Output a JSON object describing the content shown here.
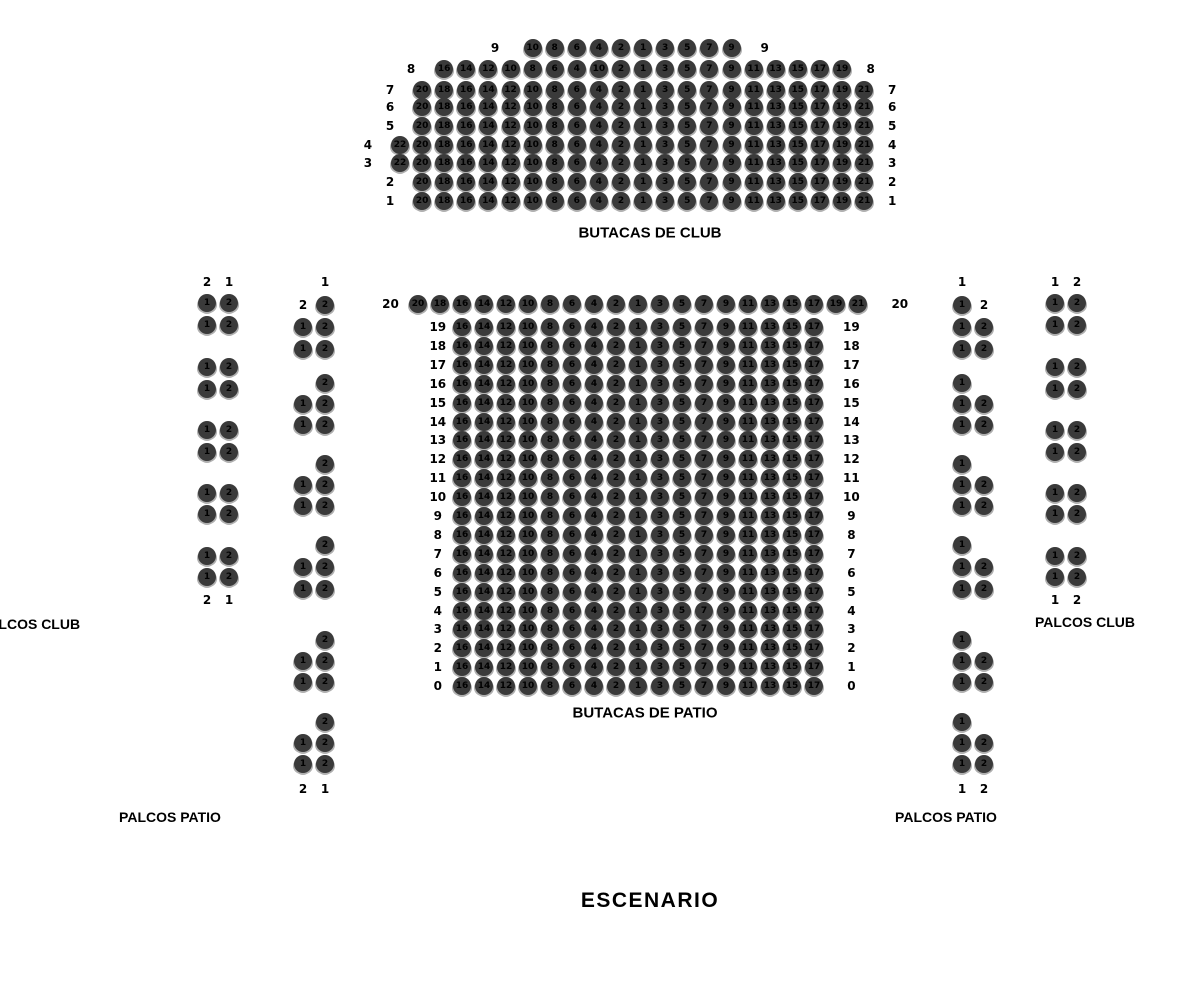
{
  "colors": {
    "background": "#ffffff",
    "seat_fill": "#3a3a3a",
    "seat_shadow": "#b0b0b0",
    "seat_number": "#000000",
    "label_color": "#000000"
  },
  "captions": {
    "club": "BUTACAS DE CLUB",
    "patio": "BUTACAS DE PATIO",
    "stage": "ESCENARIO",
    "palcos_club_left": "PALCOS CLUB",
    "palcos_club_right": "PALCOS CLUB",
    "palcos_patio_left": "PALCOS PATIO",
    "palcos_patio_right": "PALCOS PATIO"
  },
  "club_block": {
    "rows": [
      {
        "label": "9",
        "col": 6,
        "lgap": 1.7,
        "rgap": 1.5,
        "seats": [
          "10",
          "8",
          "6",
          "4",
          "2",
          "1",
          "3",
          "5",
          "7",
          "9"
        ]
      },
      {
        "label": "8",
        "col": 2,
        "lgap": 1.5,
        "rgap": 1.3,
        "seats": [
          "16",
          "14",
          "12",
          "10",
          "8",
          "6",
          "4",
          "10",
          "2",
          "1",
          "3",
          "5",
          "7",
          "9",
          "11",
          "13",
          "15",
          "17",
          "19"
        ]
      },
      {
        "label": "7",
        "col": 1,
        "seats": [
          "20",
          "18",
          "16",
          "14",
          "12",
          "10",
          "8",
          "6",
          "4",
          "2",
          "1",
          "3",
          "5",
          "7",
          "9",
          "11",
          "13",
          "15",
          "17",
          "19",
          "21"
        ]
      },
      {
        "label": "6",
        "col": 1,
        "seats": [
          "20",
          "18",
          "16",
          "14",
          "12",
          "10",
          "8",
          "6",
          "4",
          "2",
          "1",
          "3",
          "5",
          "7",
          "9",
          "11",
          "13",
          "15",
          "17",
          "19",
          "21"
        ]
      },
      {
        "label": "5",
        "col": 1,
        "seats": [
          "20",
          "18",
          "16",
          "14",
          "12",
          "10",
          "8",
          "6",
          "4",
          "2",
          "1",
          "3",
          "5",
          "7",
          "9",
          "11",
          "13",
          "15",
          "17",
          "19",
          "21"
        ]
      },
      {
        "label": "4",
        "col": 0,
        "seats": [
          "22",
          "20",
          "18",
          "16",
          "14",
          "12",
          "10",
          "8",
          "6",
          "4",
          "2",
          "1",
          "3",
          "5",
          "7",
          "9",
          "11",
          "13",
          "15",
          "17",
          "19",
          "21"
        ]
      },
      {
        "label": "3",
        "col": 0,
        "seats": [
          "22",
          "20",
          "18",
          "16",
          "14",
          "12",
          "10",
          "8",
          "6",
          "4",
          "2",
          "1",
          "3",
          "5",
          "7",
          "9",
          "11",
          "13",
          "15",
          "17",
          "19",
          "21"
        ]
      },
      {
        "label": "2",
        "col": 1,
        "seats": [
          "20",
          "18",
          "16",
          "14",
          "12",
          "10",
          "8",
          "6",
          "4",
          "2",
          "1",
          "3",
          "5",
          "7",
          "9",
          "11",
          "13",
          "15",
          "17",
          "19",
          "21"
        ]
      },
      {
        "label": "1",
        "col": 1,
        "seats": [
          "20",
          "18",
          "16",
          "14",
          "12",
          "10",
          "8",
          "6",
          "4",
          "2",
          "1",
          "3",
          "5",
          "7",
          "9",
          "11",
          "13",
          "15",
          "17",
          "19",
          "21"
        ]
      }
    ]
  },
  "patio_block": {
    "rows": [
      {
        "label": "20",
        "col": 0,
        "lgap": 1.25,
        "rgap": 1.9,
        "seats": [
          "20",
          "18",
          "16",
          "14",
          "12",
          "10",
          "8",
          "6",
          "4",
          "2",
          "1",
          "3",
          "5",
          "7",
          "9",
          "11",
          "13",
          "15",
          "17",
          "19",
          "21"
        ]
      },
      {
        "label": "19",
        "col": 2,
        "seats": [
          "16",
          "14",
          "12",
          "10",
          "8",
          "6",
          "4",
          "2",
          "1",
          "3",
          "5",
          "7",
          "9",
          "11",
          "13",
          "15",
          "17"
        ]
      },
      {
        "label": "18",
        "col": 2,
        "seats": [
          "16",
          "14",
          "12",
          "10",
          "8",
          "6",
          "4",
          "2",
          "1",
          "3",
          "5",
          "7",
          "9",
          "11",
          "13",
          "15",
          "17"
        ]
      },
      {
        "label": "17",
        "col": 2,
        "seats": [
          "16",
          "14",
          "12",
          "10",
          "8",
          "6",
          "4",
          "2",
          "1",
          "3",
          "5",
          "7",
          "9",
          "11",
          "13",
          "15",
          "17"
        ]
      },
      {
        "label": "16",
        "col": 2,
        "seats": [
          "16",
          "14",
          "12",
          "10",
          "8",
          "6",
          "4",
          "2",
          "1",
          "3",
          "5",
          "7",
          "9",
          "11",
          "13",
          "15",
          "17"
        ]
      },
      {
        "label": "15",
        "col": 2,
        "seats": [
          "16",
          "14",
          "12",
          "10",
          "8",
          "6",
          "4",
          "2",
          "1",
          "3",
          "5",
          "7",
          "9",
          "11",
          "13",
          "15",
          "17"
        ]
      },
      {
        "label": "14",
        "col": 2,
        "seats": [
          "16",
          "14",
          "12",
          "10",
          "8",
          "6",
          "4",
          "2",
          "1",
          "3",
          "5",
          "7",
          "9",
          "11",
          "13",
          "15",
          "17"
        ]
      },
      {
        "label": "13",
        "col": 2,
        "seats": [
          "16",
          "14",
          "12",
          "10",
          "8",
          "6",
          "4",
          "2",
          "1",
          "3",
          "5",
          "7",
          "9",
          "11",
          "13",
          "15",
          "17"
        ]
      },
      {
        "label": "12",
        "col": 2,
        "seats": [
          "16",
          "14",
          "12",
          "10",
          "8",
          "6",
          "4",
          "2",
          "1",
          "3",
          "5",
          "7",
          "9",
          "11",
          "13",
          "15",
          "17"
        ]
      },
      {
        "label": "11",
        "col": 2,
        "seats": [
          "16",
          "14",
          "12",
          "10",
          "8",
          "6",
          "4",
          "2",
          "1",
          "3",
          "5",
          "7",
          "9",
          "11",
          "13",
          "15",
          "17"
        ]
      },
      {
        "label": "10",
        "col": 2,
        "seats": [
          "16",
          "14",
          "12",
          "10",
          "8",
          "6",
          "4",
          "2",
          "1",
          "3",
          "5",
          "7",
          "9",
          "11",
          "13",
          "15",
          "17"
        ]
      },
      {
        "label": "9",
        "col": 2,
        "seats": [
          "16",
          "14",
          "12",
          "10",
          "8",
          "6",
          "4",
          "2",
          "1",
          "3",
          "5",
          "7",
          "9",
          "11",
          "13",
          "15",
          "17"
        ]
      },
      {
        "label": "8",
        "col": 2,
        "seats": [
          "16",
          "14",
          "12",
          "10",
          "8",
          "6",
          "4",
          "2",
          "1",
          "3",
          "5",
          "7",
          "9",
          "11",
          "13",
          "15",
          "17"
        ]
      },
      {
        "label": "7",
        "col": 2,
        "seats": [
          "16",
          "14",
          "12",
          "10",
          "8",
          "6",
          "4",
          "2",
          "1",
          "3",
          "5",
          "7",
          "9",
          "11",
          "13",
          "15",
          "17"
        ]
      },
      {
        "label": "6",
        "col": 2,
        "seats": [
          "16",
          "14",
          "12",
          "10",
          "8",
          "6",
          "4",
          "2",
          "1",
          "3",
          "5",
          "7",
          "9",
          "11",
          "13",
          "15",
          "17"
        ]
      },
      {
        "label": "5",
        "col": 2,
        "seats": [
          "16",
          "14",
          "12",
          "10",
          "8",
          "6",
          "4",
          "2",
          "1",
          "3",
          "5",
          "7",
          "9",
          "11",
          "13",
          "15",
          "17"
        ]
      },
      {
        "label": "4",
        "col": 2,
        "seats": [
          "16",
          "14",
          "12",
          "10",
          "8",
          "6",
          "4",
          "2",
          "1",
          "3",
          "5",
          "7",
          "9",
          "11",
          "13",
          "15",
          "17"
        ]
      },
      {
        "label": "3",
        "col": 2,
        "seats": [
          "16",
          "14",
          "12",
          "10",
          "8",
          "6",
          "4",
          "2",
          "1",
          "3",
          "5",
          "7",
          "9",
          "11",
          "13",
          "15",
          "17"
        ]
      },
      {
        "label": "2",
        "col": 2,
        "seats": [
          "16",
          "14",
          "12",
          "10",
          "8",
          "6",
          "4",
          "2",
          "1",
          "3",
          "5",
          "7",
          "9",
          "11",
          "13",
          "15",
          "17"
        ]
      },
      {
        "label": "1",
        "col": 2,
        "seats": [
          "16",
          "14",
          "12",
          "10",
          "8",
          "6",
          "4",
          "2",
          "1",
          "3",
          "5",
          "7",
          "9",
          "11",
          "13",
          "15",
          "17"
        ]
      },
      {
        "label": "0",
        "col": 2,
        "seats": [
          "16",
          "14",
          "12",
          "10",
          "8",
          "6",
          "4",
          "2",
          "1",
          "3",
          "5",
          "7",
          "9",
          "11",
          "13",
          "15",
          "17"
        ]
      }
    ]
  },
  "palcos": {
    "left_outer": {
      "header": [
        "2",
        "1"
      ],
      "footer": [
        "2",
        "1"
      ],
      "groups": [
        [
          [
            "1",
            "2"
          ],
          [
            "1",
            "2"
          ]
        ],
        [
          [
            "1",
            "2"
          ],
          [
            "1",
            "2"
          ]
        ],
        [
          [
            "1",
            "2"
          ],
          [
            "1",
            "2"
          ]
        ],
        [
          [
            "1",
            "2"
          ],
          [
            "1",
            "2"
          ]
        ],
        [
          [
            "1",
            "2"
          ],
          [
            "1",
            "2"
          ]
        ]
      ]
    },
    "left_inner": {
      "header": [
        null,
        "1"
      ],
      "footer": [
        "2",
        "1"
      ],
      "groups": [
        [
          [
            {
              "label": "2"
            },
            "2"
          ],
          [
            "1",
            "2"
          ],
          [
            "1",
            "2"
          ]
        ],
        [
          [
            null,
            "2"
          ],
          [
            "1",
            "2"
          ],
          [
            "1",
            "2"
          ]
        ],
        [
          [
            null,
            "2"
          ],
          [
            "1",
            "2"
          ],
          [
            "1",
            "2"
          ]
        ],
        [
          [
            null,
            "2"
          ],
          [
            "1",
            "2"
          ],
          [
            "1",
            "2"
          ]
        ],
        [
          [
            null,
            "2"
          ],
          [
            "1",
            "2"
          ],
          [
            "1",
            "2"
          ]
        ],
        [
          [
            null,
            "2"
          ],
          [
            "1",
            "2"
          ],
          [
            "1",
            "2"
          ]
        ]
      ]
    },
    "right_inner": {
      "header": [
        "1",
        null
      ],
      "footer": [
        "1",
        "2"
      ],
      "groups": [
        [
          [
            "1",
            {
              "label": "2"
            }
          ],
          [
            "1",
            "2"
          ],
          [
            "1",
            "2"
          ]
        ],
        [
          [
            "1",
            null
          ],
          [
            "1",
            "2"
          ],
          [
            "1",
            "2"
          ]
        ],
        [
          [
            "1",
            null
          ],
          [
            "1",
            "2"
          ],
          [
            "1",
            "2"
          ]
        ],
        [
          [
            "1",
            null
          ],
          [
            "1",
            "2"
          ],
          [
            "1",
            "2"
          ]
        ],
        [
          [
            "1",
            null
          ],
          [
            "1",
            "2"
          ],
          [
            "1",
            "2"
          ]
        ],
        [
          [
            "1",
            null
          ],
          [
            "1",
            "2"
          ],
          [
            "1",
            "2"
          ]
        ]
      ]
    },
    "right_outer": {
      "header": [
        "1",
        "2"
      ],
      "footer": [
        "1",
        "2"
      ],
      "groups": [
        [
          [
            "1",
            "2"
          ],
          [
            "1",
            "2"
          ]
        ],
        [
          [
            "1",
            "2"
          ],
          [
            "1",
            "2"
          ]
        ],
        [
          [
            "1",
            "2"
          ],
          [
            "1",
            "2"
          ]
        ],
        [
          [
            "1",
            "2"
          ],
          [
            "1",
            "2"
          ]
        ],
        [
          [
            "1",
            "2"
          ],
          [
            "1",
            "2"
          ]
        ]
      ]
    }
  }
}
